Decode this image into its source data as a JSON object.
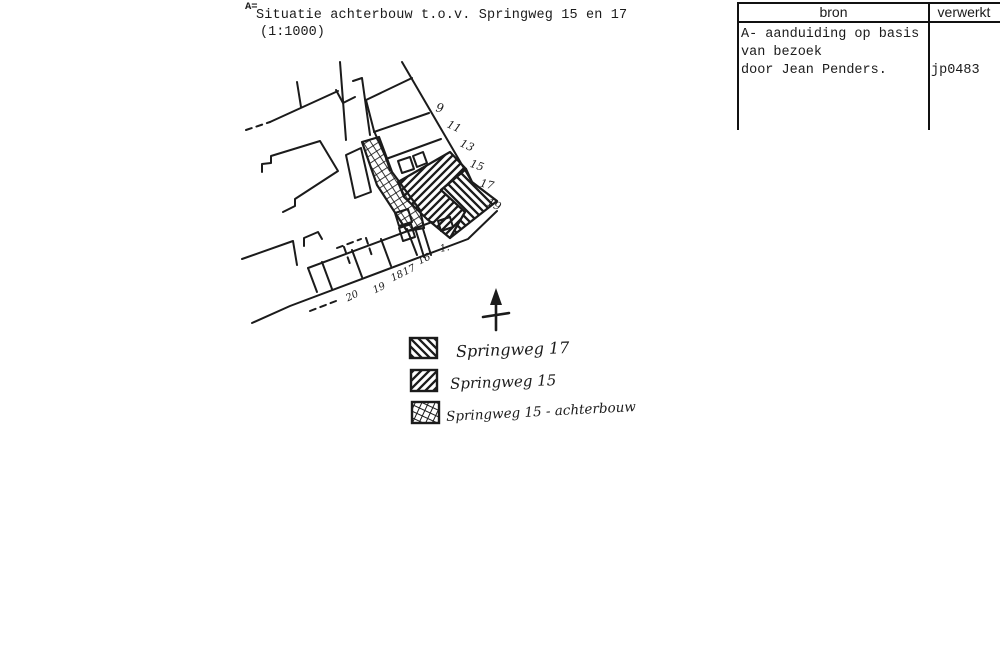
{
  "colors": {
    "ink": "#1b1b1b",
    "paper": "#ffffff"
  },
  "title": {
    "prefix": "A=",
    "line1": "Situatie achterbouw t.o.v. Springweg 15 en 17",
    "scale": "(1:1000)"
  },
  "table": {
    "header_bron": "bron",
    "header_verwerkt": "verwerkt",
    "bron_lines": [
      "A- aanduiding op basis",
      "van bezoek",
      "door Jean Penders."
    ],
    "verwerkt_value": "jp0483"
  },
  "legend": {
    "items": [
      {
        "pattern": "diagonal-back-hatch",
        "label": "Springweg 17"
      },
      {
        "pattern": "diagonal-forward-hatch",
        "label": "Springweg 15"
      },
      {
        "pattern": "crosshatch",
        "label": "Springweg 15 - achterbouw"
      }
    ]
  },
  "map": {
    "numbers_east": [
      "9",
      "11",
      "13",
      "15",
      "17",
      "19"
    ],
    "numbers_south": [
      "20",
      "19",
      "18",
      "17",
      "16",
      "1."
    ],
    "north_arrow": "north"
  }
}
